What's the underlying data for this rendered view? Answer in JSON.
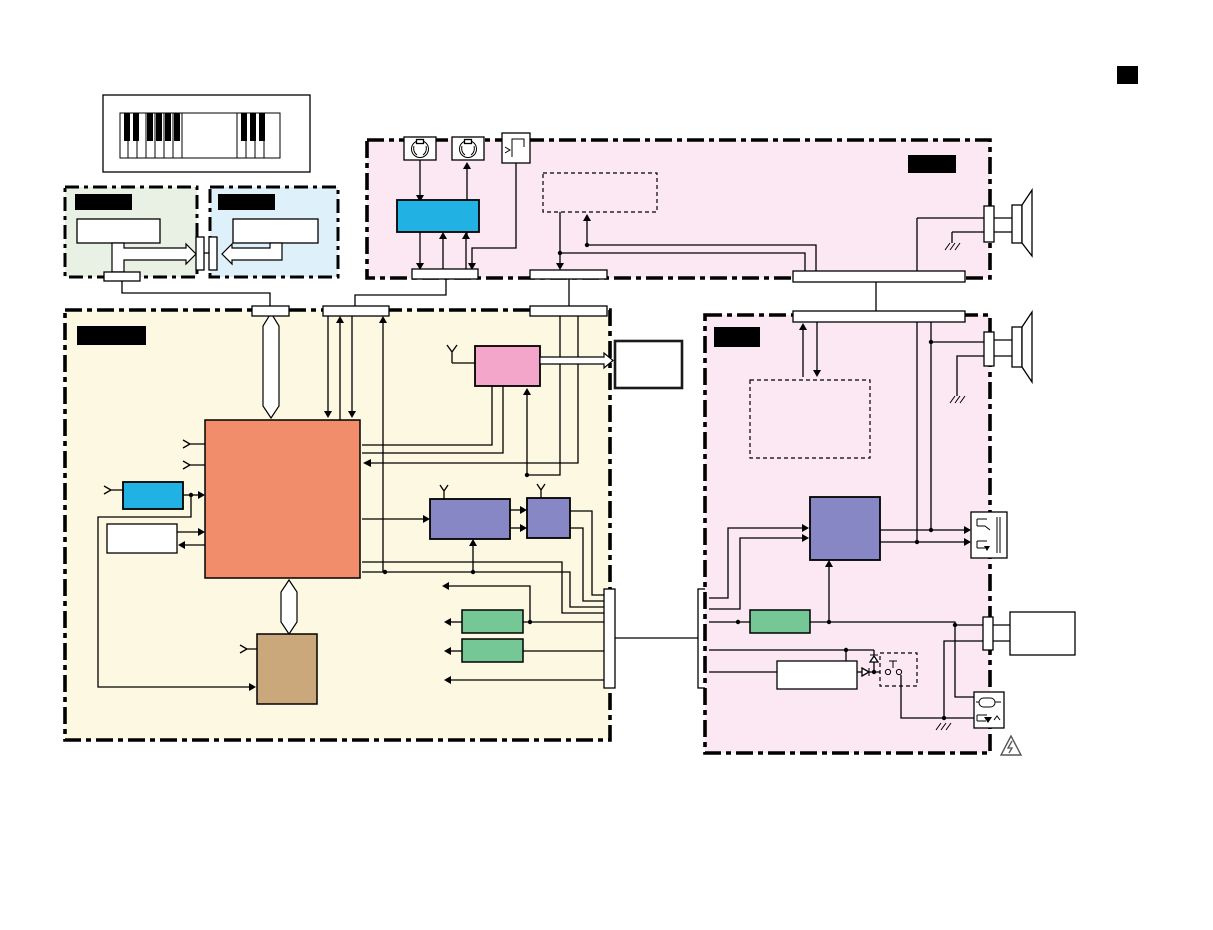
{
  "figure": {
    "type": "block-diagram",
    "description": "Electronic keyboard service-manual overall block diagram with redacted (blacked-out) board name labels",
    "text_visible": false
  },
  "colors": {
    "panel_pink": "#fce8f2",
    "panel_yellow": "#fcf8e1",
    "panel_green": "#e9f0e4",
    "panel_blue": "#def0fa",
    "block_blue": "#21b2e3",
    "block_orange": "#f18d6b",
    "block_pink": "#f3a5ca",
    "block_purple": "#8787c6",
    "block_green": "#75c795",
    "block_brown": "#cba87b",
    "line": "#000000",
    "redacted_label": "#000000",
    "background": "#ffffff"
  },
  "labels": {
    "green_panel_label": {
      "redacted": true,
      "text": ""
    },
    "blue_panel_label": {
      "redacted": true,
      "text": ""
    },
    "top_pink_panel_label": {
      "redacted": true,
      "text": ""
    },
    "yellow_panel_label": {
      "redacted": true,
      "text": ""
    },
    "right_pink_panel_label": {
      "redacted": true,
      "text": ""
    }
  },
  "icons": [
    "keyboard-icon",
    "midi-din-connector-icon",
    "midi-din-connector-icon",
    "pedal-jack-icon",
    "speaker-icon",
    "speaker-icon",
    "headphone-jack-icon",
    "power-inlet-icon",
    "ground-icon",
    "ground-icon",
    "ground-icon",
    "warning-triangle-icon",
    "antenna-icon",
    "diode-icon",
    "switch-icon",
    "black-square-marker"
  ],
  "counts": {
    "panels": 5,
    "dashed_option_boxes": 3,
    "connector_bars": 10,
    "speakers": 2
  }
}
